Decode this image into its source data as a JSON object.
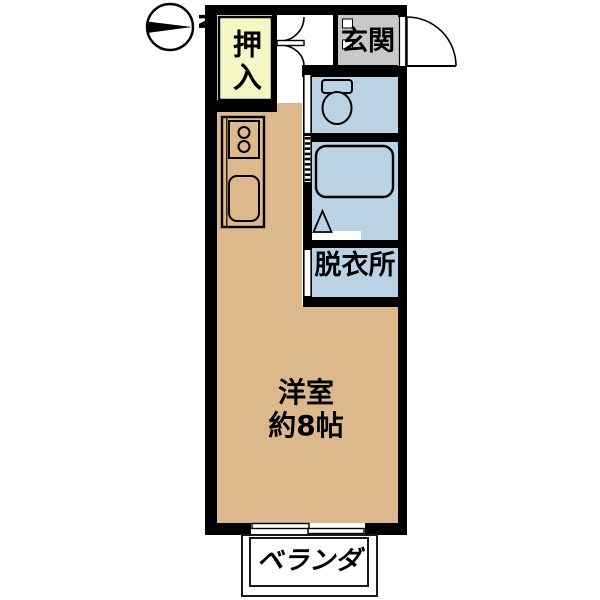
{
  "compass": {
    "north_label": "N"
  },
  "rooms": {
    "closet": {
      "label": "押入"
    },
    "entrance": {
      "label": "玄関"
    },
    "dressing_room": {
      "label": "脱衣所"
    },
    "western_room": {
      "label": "洋室",
      "size": "約8帖"
    },
    "veranda": {
      "label": "ベランダ"
    }
  },
  "colors": {
    "background": "#ffffff",
    "wall": "#000000",
    "room_floor": "#dcb88c",
    "closet_fill": "#f6f6c5",
    "wet_area_fill": "#b9d3e5",
    "entrance_fill": "#c8c8c8"
  }
}
